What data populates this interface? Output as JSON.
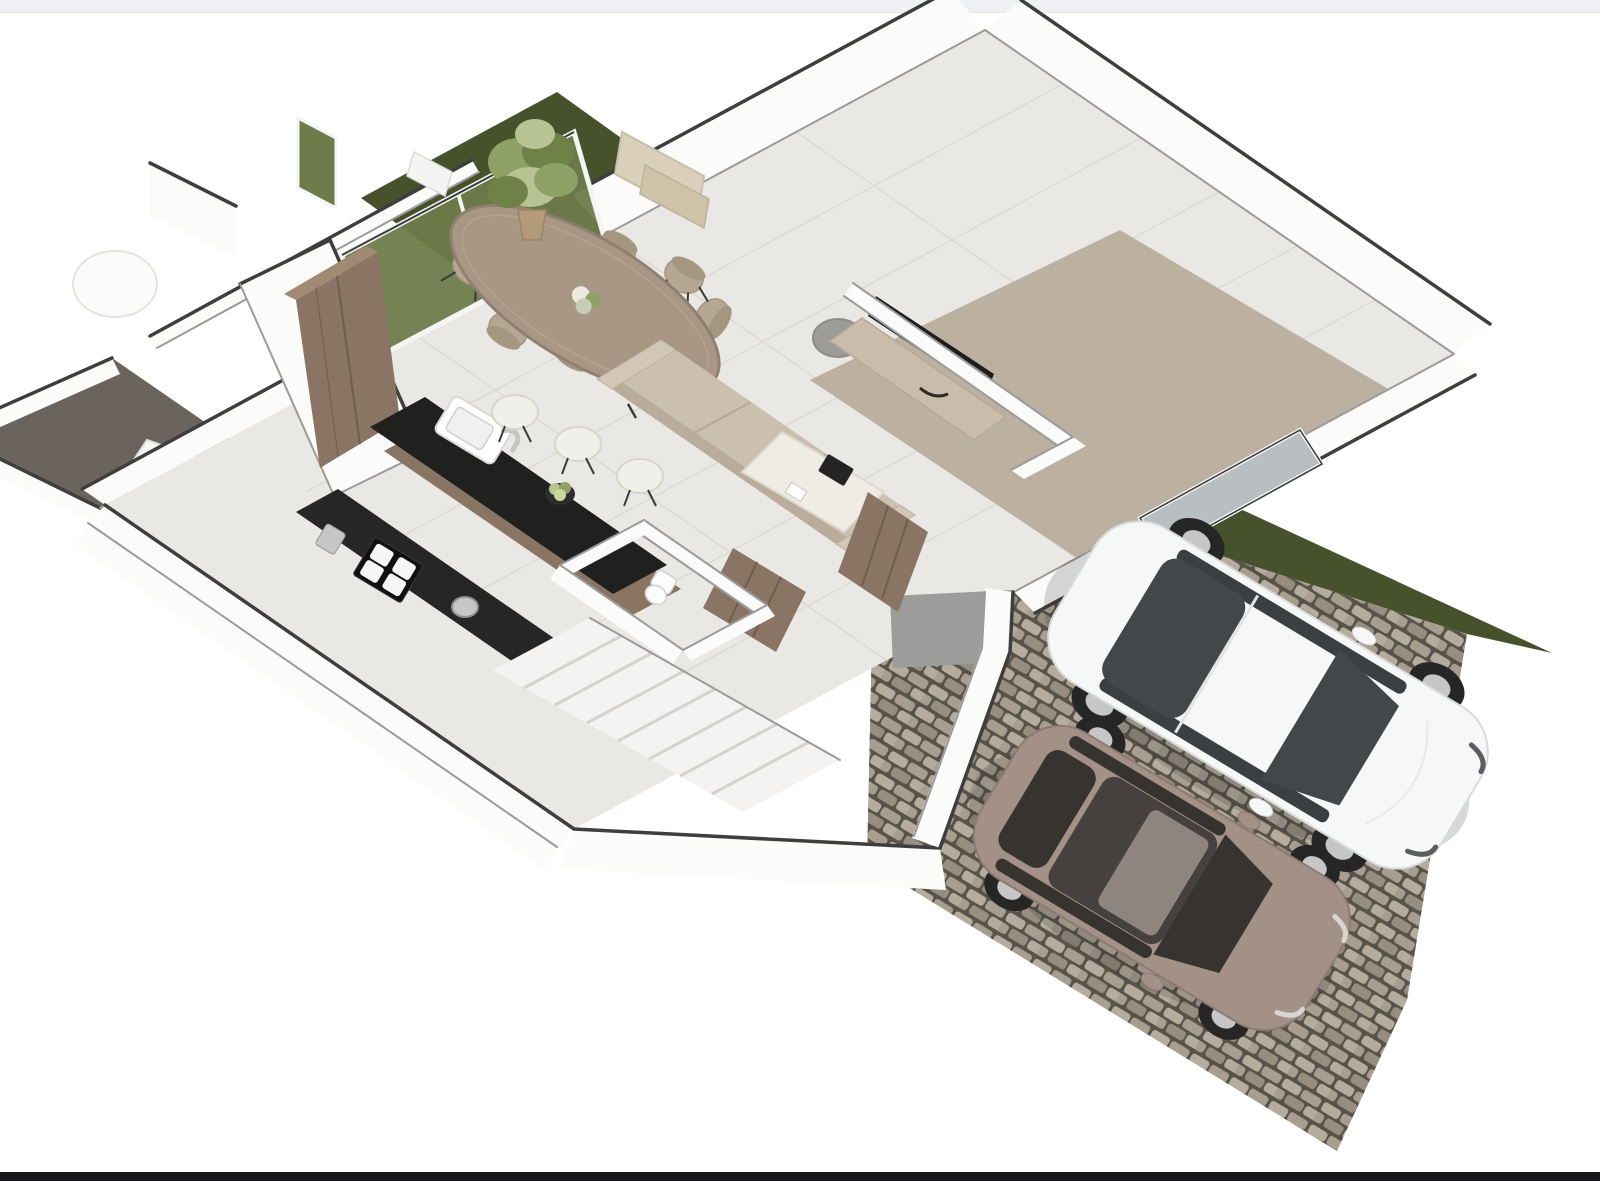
{
  "scene": {
    "title": "3D isometric floor plan rendering",
    "description": "Photorealistic 3D ground-floor plan of a townhouse with open living-dining-kitchen, staircase, WC, rear terrace, lawn and a cobblestone driveway with two parked cars",
    "rooms": [
      {
        "name": "living-area",
        "furniture": [
          "beige-sofa",
          "tv-console",
          "flat-tv",
          "coffee-table",
          "round-side-table"
        ]
      },
      {
        "name": "dining-area",
        "furniture": [
          "oval-wood-table",
          "upholstered-chairs",
          "flower-centerpiece"
        ],
        "chair_count": 8
      },
      {
        "name": "kitchen",
        "furniture": [
          "island-with-sink-and-faucet",
          "bar-stools",
          "wall-counter-with-cooktop",
          "tall-wood-cabinet",
          "fruit-bowl"
        ],
        "stool_count": 3
      },
      {
        "name": "hallway",
        "furniture": [
          "staircase",
          "wood-storage-units"
        ],
        "stair_tread_count": 8
      },
      {
        "name": "wc",
        "furniture": [
          "toilet"
        ]
      },
      {
        "name": "bathroom-block",
        "furniture": []
      },
      {
        "name": "terrace",
        "furniture": [
          "white-bench",
          "round-planter"
        ]
      }
    ],
    "outdoor": {
      "lawn": "dark-green grass bands behind the glass door and along the driveway",
      "driveway_paving": "grey cobblestone",
      "cars": [
        {
          "type": "sedan",
          "color_name": "white",
          "heading_deg": 31
        },
        {
          "type": "hatchback",
          "color_name": "taupe-brown",
          "heading_deg": 31
        }
      ],
      "car_count": 2
    },
    "architecture": {
      "wall_color": "white with dark grey top caps",
      "glazing": [
        "two-panel sliding glass door (olive tinted)",
        "narrow fixed sidelight",
        "picture window on driveway side"
      ],
      "wall_art_count": 2,
      "potted_plant": "corner ficus in tan pot"
    }
  },
  "palette": {
    "bg": "#ffffff",
    "top-strip": "#eef0f3",
    "bottom-bar": "#16181b",
    "wall": "#fbfbfa",
    "wall-cap": "#3e3e3e",
    "wall-soft": "#9b9b9b",
    "floor": "#eae8e4",
    "floor-line": "#dcd9d3",
    "floor-living": "#b7aa99",
    "floor-hall": "#9c9c9a",
    "terrace-floor": "#6b645c",
    "grass": "#47522d",
    "glass-door": "#6e7b4a",
    "window-glass": "#b9bec0",
    "wood": "#8a7463",
    "wood-dark": "#6f5d4d",
    "wood-light": "#a08a74",
    "counter": "#262626",
    "island-top": "#20201f",
    "sink": "#ffffff",
    "steel": "#c6c6c6",
    "table": "#a79784",
    "table-edge": "#8f8070",
    "chair": "#b6a795",
    "chair-leg": "#3a3a3a",
    "sofa": "#cbbfae",
    "sofa-shade": "#b9ac9a",
    "console": "#c9bcaa",
    "tv": "#1d1d1d",
    "coffee-table": "#efece4",
    "side-table": "#9b9b98",
    "stool": "#f1efe9",
    "cobble-joint": "#57524a",
    "stone-a": "#b5ac9d",
    "stone-b": "#a79e8f",
    "stone-c": "#978e80",
    "car-white": "#f6f7f7",
    "car-white-trim": "#d9dadb",
    "glass-dark": "#43474a",
    "car-brown": "#a39086",
    "car-brown-roof": "#46413e",
    "car-brown-glass": "#37332f",
    "wheel": "#262626",
    "rim": "#c6c6c6",
    "plant": "#8da167",
    "plant-dark": "#6e8248",
    "plant-light": "#b8c394",
    "pot": "#b39b79",
    "art": "#d9cfba",
    "art2": "#cec2a9"
  }
}
